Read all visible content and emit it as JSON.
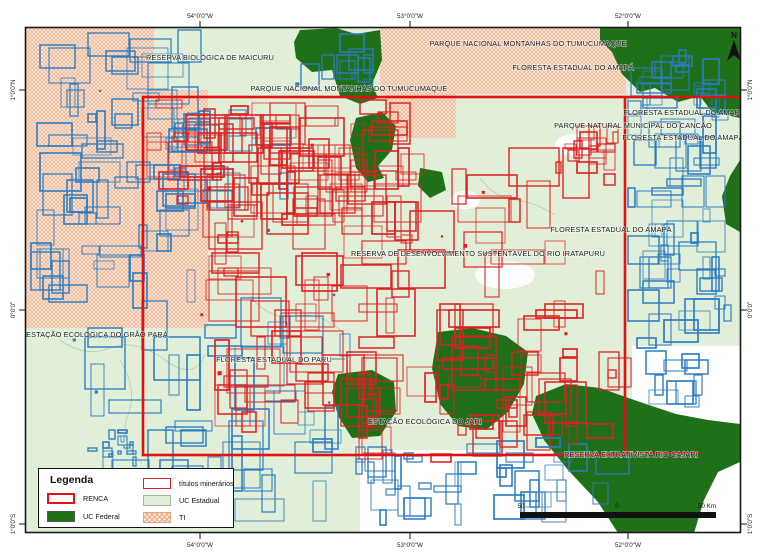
{
  "map": {
    "labels": [
      {
        "text": "RESERVA BIOLÓGICA DE MAICURU"
      },
      {
        "text": "PARQUE NACIONAL MONTANHAS DO TUMUCUMAQUE"
      },
      {
        "text": "FLORESTA ESTADUAL DO AMAPÁ"
      },
      {
        "text": "PARQUE NACIONAL MONTANHAS DO TUMUCUMAQUE"
      },
      {
        "text": "FLORESTA ESTADUAL DO AMAPÁ"
      },
      {
        "text": "PARQUE NATURAL MUNICIPAL DO CANCÃO"
      },
      {
        "text": "FLORESTA ESTADUAL DO AMAPÁ"
      },
      {
        "text": "FLORESTA ESTADUAL DO AMAPÁ"
      },
      {
        "text": "RESERVA DE DESENVOLVIMENTO SUSTENTÁVEL DO RIO IRATAPURU"
      },
      {
        "text": "ESTAÇÃO ECOLÓGICA DO GRÃO PARÁ"
      },
      {
        "text": "FLORESTA ESTADUAL DO PARU"
      },
      {
        "text": "ESTAÇÃO ECOLÓGICA DO JARI"
      },
      {
        "text": "RESERVA EXTRATIVISTA RIO CAJARI"
      }
    ],
    "grid": {
      "top": [
        "54°0'0\"W",
        "53°0'0\"W",
        "52°0'0\"W"
      ],
      "bottom": [
        "54°0'0\"W",
        "53°0'0\"W",
        "52°0'0\"W"
      ],
      "left": [
        "1°0'0\"N",
        "0°0'0\"",
        "1°0'0\"S"
      ],
      "right": [
        "1°0'0\"N",
        "0°0'0\"",
        "1°0'0\"S"
      ]
    },
    "north_label": "N",
    "scale": {
      "left": "50",
      "mid": "0",
      "right": "50 Km"
    }
  },
  "legend": {
    "title": "Legenda",
    "items": [
      {
        "label": "RENCA"
      },
      {
        "label": "UC Federal"
      },
      {
        "label": "títulos minerários"
      },
      {
        "label": "UC Estadual"
      },
      {
        "label": "TI"
      }
    ]
  },
  "colors": {
    "renca": "#e01212",
    "titulos": "#dd2222",
    "uc_federal": "#1f7019",
    "uc_estadual": "#e1efd9",
    "ti_bg": "#fcebdc",
    "ti_hatch": "#eeab87",
    "blue_claims": "#2b7cc0"
  }
}
